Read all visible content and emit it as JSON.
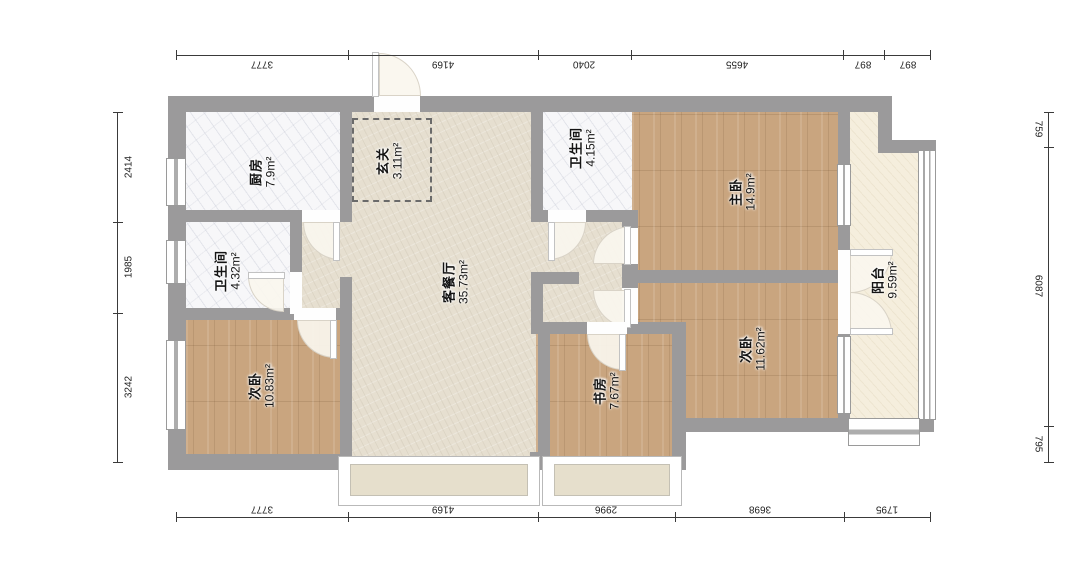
{
  "title": "apartment-floor-plan",
  "palette": {
    "wall": "#9b9a9b",
    "living-floor": "#e6dfd0",
    "wood-floor": "#c9a57f",
    "marble-floor": "#f7f7f9",
    "balcony-floor": "#f5eedd",
    "bay-fill": "#e6dfcc",
    "text": "#141414"
  },
  "rooms": [
    {
      "id": "kitchen",
      "name": "厨房",
      "area": "7.9m²"
    },
    {
      "id": "entry",
      "name": "玄关",
      "area": "3.11m²"
    },
    {
      "id": "bath-main",
      "name": "卫生间",
      "area": "4.15m²"
    },
    {
      "id": "master-bedroom",
      "name": "主卧",
      "area": "14.9m²"
    },
    {
      "id": "bath-second",
      "name": "卫生间",
      "area": "4.32m²"
    },
    {
      "id": "living-dining",
      "name": "客餐厅",
      "area": "35.73m²"
    },
    {
      "id": "bedroom-left",
      "name": "次卧",
      "area": "10.83m²"
    },
    {
      "id": "study",
      "name": "书房",
      "area": "7.67m²"
    },
    {
      "id": "bedroom-right",
      "name": "次卧",
      "area": "11.62m²"
    },
    {
      "id": "balcony",
      "name": "阳台",
      "area": "9.59m²"
    }
  ],
  "dimensions": {
    "top": [
      "3777",
      "4169",
      "2040",
      "4655",
      "897",
      "897"
    ],
    "bottom": [
      "3777",
      "4169",
      "2996",
      "3698",
      "1795"
    ],
    "left": [
      "2414",
      "1985",
      "3242"
    ],
    "right": [
      "759",
      "6087",
      "795"
    ]
  }
}
